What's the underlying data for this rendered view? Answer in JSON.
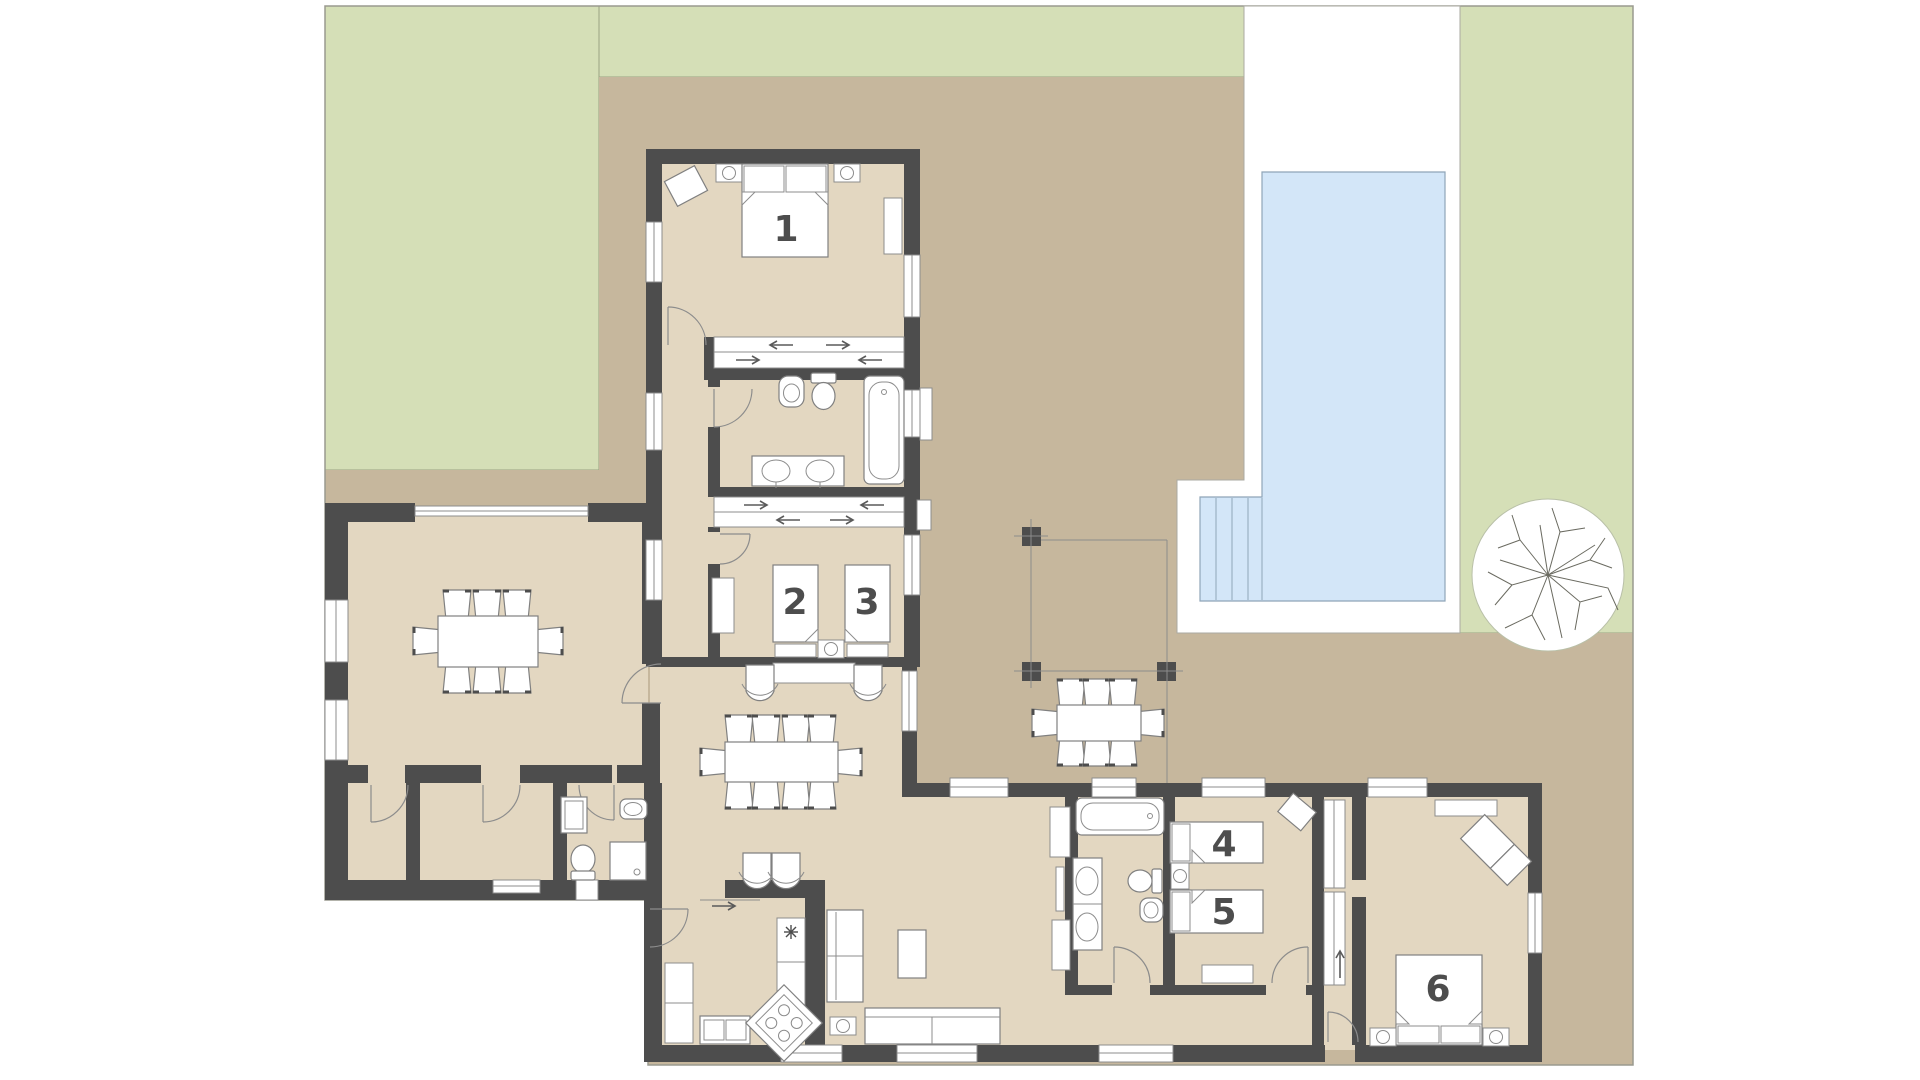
{
  "plan": {
    "type": "residential-floor-plan",
    "rooms": [
      {
        "id": "bedroom-1",
        "label": "1"
      },
      {
        "id": "bed-2",
        "label": "2"
      },
      {
        "id": "bed-3",
        "label": "3"
      },
      {
        "id": "bed-4",
        "label": "4"
      },
      {
        "id": "bed-5",
        "label": "5"
      },
      {
        "id": "bedroom-6",
        "label": "6"
      }
    ],
    "outdoor_features": [
      "lawn",
      "terrace",
      "swimming-pool",
      "pool-steps",
      "tree",
      "pergola",
      "outdoor-dining-table"
    ],
    "colors": {
      "wall": "#4d4d4d",
      "floor": "#e3d7c1",
      "terrace": "#c6b79d",
      "lawn": "#d5dfb7",
      "pool": "#d3e6f8",
      "paving": "#ffffff",
      "line": "#8c8c8c"
    }
  }
}
